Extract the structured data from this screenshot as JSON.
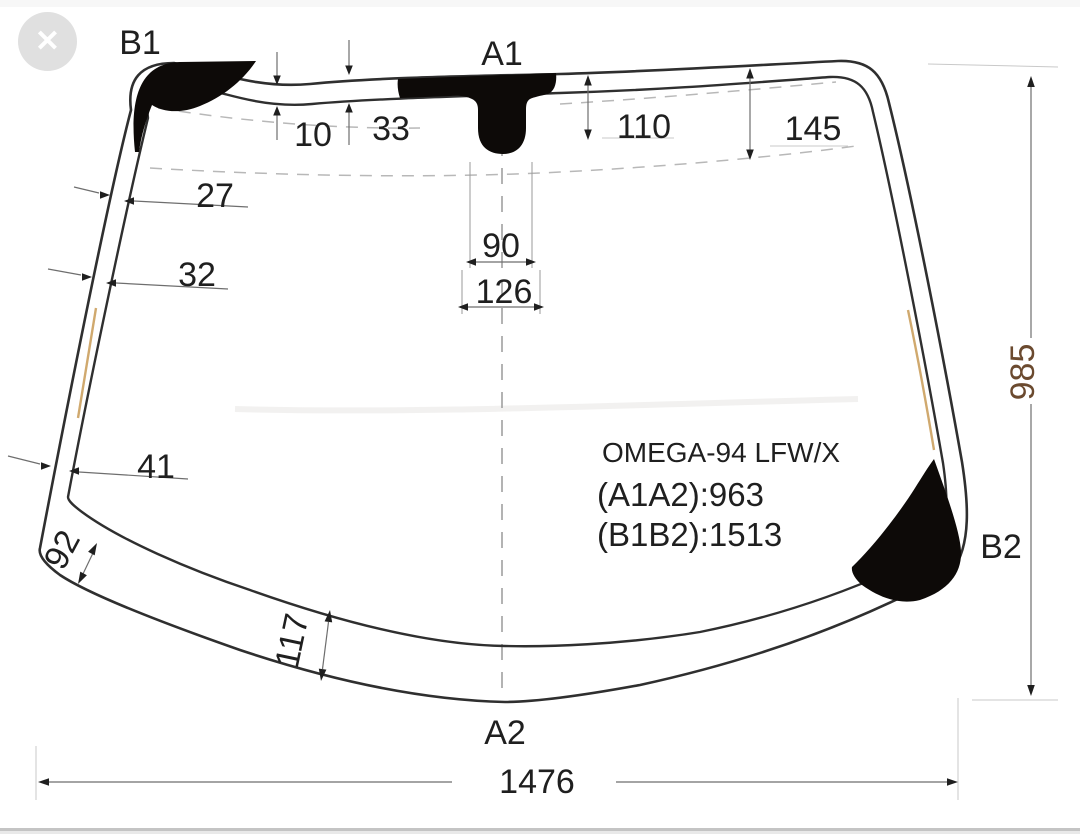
{
  "overlay": {
    "close_icon": "✕"
  },
  "part": {
    "name": "OMEGA-94 LFW/X",
    "spec_a1a2": "(A1A2):963",
    "spec_b1b2": "(B1B2):1513"
  },
  "labels": {
    "top_left": "B1",
    "top_center": "A1",
    "bottom_center": "A2",
    "bottom_right": "B2"
  },
  "dims": {
    "d10": "10",
    "d33": "33",
    "d110": "110",
    "d145": "145",
    "d27": "27",
    "d32": "32",
    "d41": "41",
    "d90": "90",
    "d126": "126",
    "d92": "92",
    "d117": "117",
    "d985": "985",
    "d1476": "1476"
  },
  "colors": {
    "outline": "#2f2f2f",
    "ceramic_band": "#0d0a08",
    "dimension_line": "#6e6e6e",
    "dashed_line": "#b8b8b8",
    "edge_tint": "#c89a55",
    "height_number": "#6b4a2f",
    "close_button_bg": "#e0e0e0",
    "bottom_divider": "#c4c4c4"
  }
}
